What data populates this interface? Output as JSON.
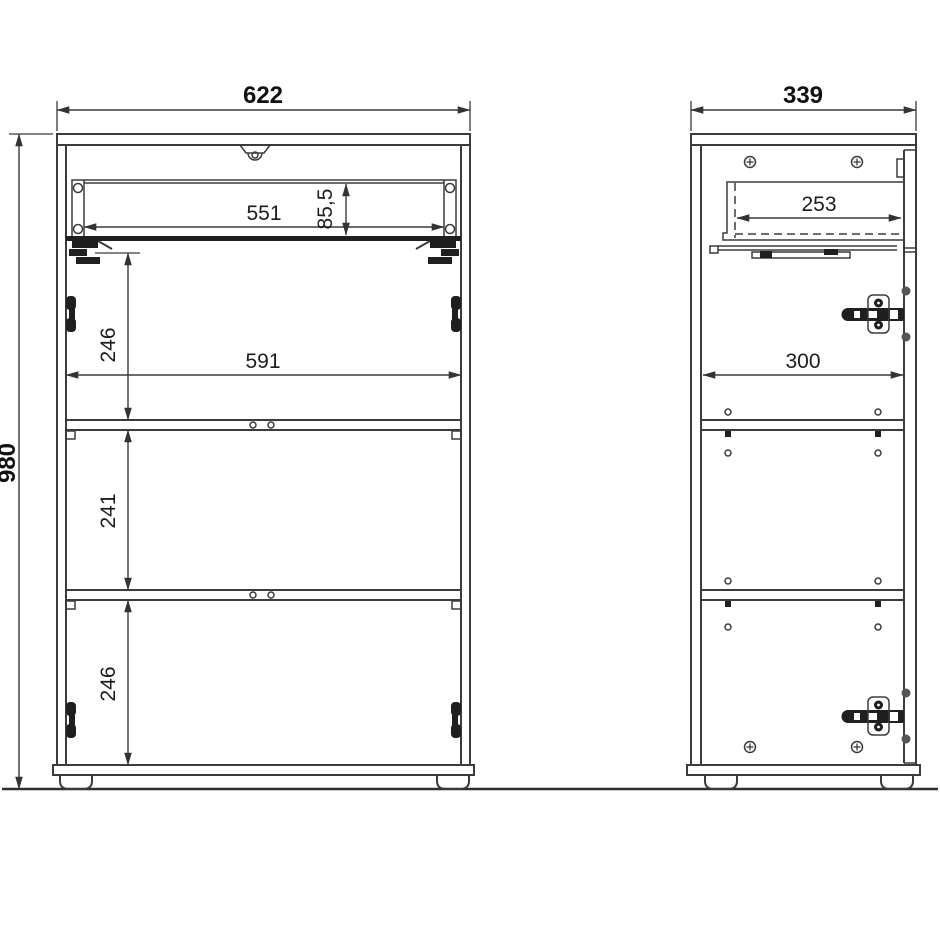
{
  "figure": {
    "type": "furniture-technical-drawing",
    "front_view": {
      "dims": {
        "overall_width": "622",
        "overall_height": "980",
        "drawer_opening_width": "551",
        "drawer_height": "85,5",
        "upper_section_height": "246",
        "interior_width": "591",
        "middle_section_height": "241",
        "lower_section_height": "246"
      }
    },
    "side_view": {
      "dims": {
        "overall_depth": "339",
        "drawer_depth": "253",
        "interior_depth": "300"
      }
    },
    "colors": {
      "line": "#3b3b3b",
      "dimension_text": "#1c1c1c",
      "dark_hardware": "#1f1f1f",
      "background": "#ffffff"
    }
  }
}
